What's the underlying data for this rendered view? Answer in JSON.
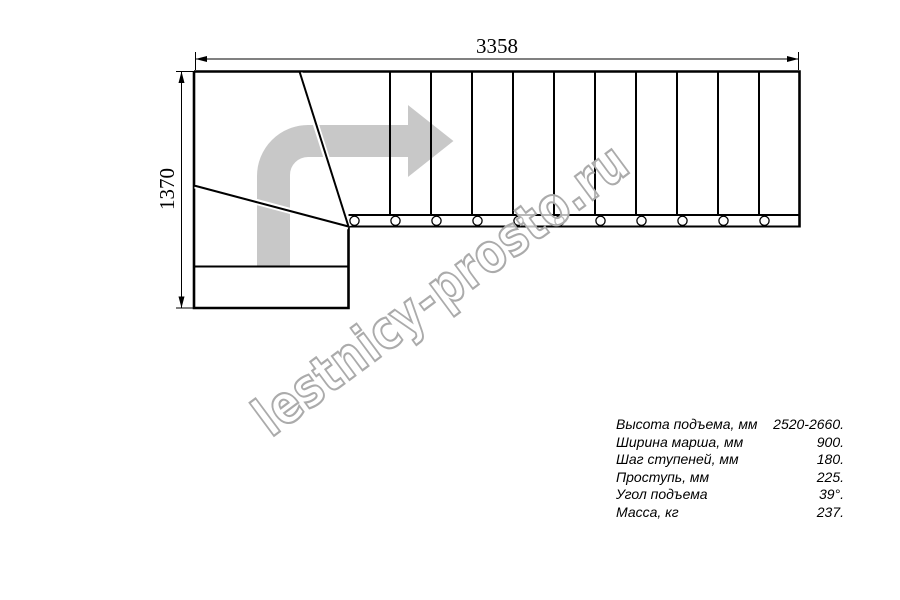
{
  "diagram": {
    "title": "stair-plan-top-view",
    "top_dimension": "3358",
    "left_dimension": "1370",
    "watermark": "lestnicy-prosto.ru",
    "colors": {
      "line": "#000000",
      "arrow_fill": "#c8c8c8",
      "watermark_stroke": "#ababab"
    }
  },
  "specs": {
    "rows": [
      {
        "label": "Высота подъема, мм",
        "value": "2520-2660."
      },
      {
        "label": "Ширина марша, мм",
        "value": "900."
      },
      {
        "label": "Шаг ступеней, мм",
        "value": "180."
      },
      {
        "label": "Проступь, мм",
        "value": "225."
      },
      {
        "label": "Угол подъема",
        "value": "39°."
      },
      {
        "label": "Масса, кг",
        "value": "237."
      }
    ]
  }
}
